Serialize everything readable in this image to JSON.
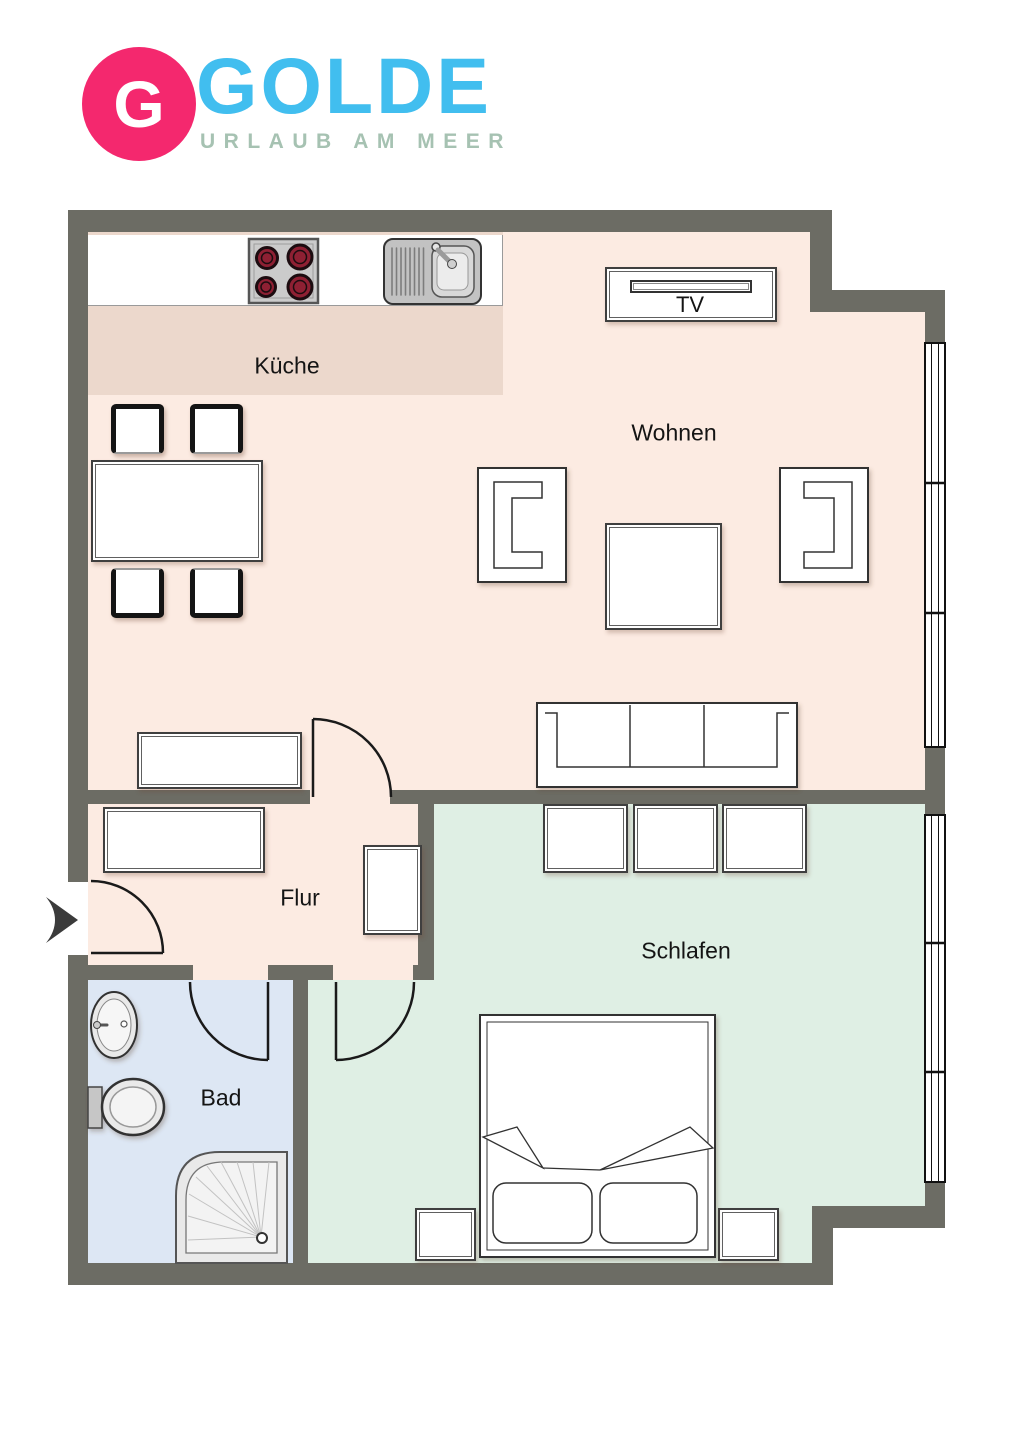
{
  "logo": {
    "badge_letter": "G",
    "brand": "GOLDE",
    "tagline": "URLAUB AM MEER",
    "badge_color": "#F4286E",
    "brand_color": "#41BEEF",
    "tagline_color": "#A6C2B2"
  },
  "floorplan": {
    "wall_color": "#6C6C64",
    "rooms": [
      {
        "id": "kueche",
        "label": "Küche",
        "floor_color": "#ECD8CC"
      },
      {
        "id": "wohnen",
        "label": "Wohnen",
        "floor_color": "#FCEBE2"
      },
      {
        "id": "flur",
        "label": "Flur",
        "floor_color": "#FCEBE2"
      },
      {
        "id": "bad",
        "label": "Bad",
        "floor_color": "#DDE7F4"
      },
      {
        "id": "schlafen",
        "label": "Schlafen",
        "floor_color": "#DFEFE4"
      }
    ],
    "tv_label": "TV",
    "furniture": [
      "stove",
      "kitchen-sink",
      "dining-table",
      "dining-chair x4",
      "tv-sideboard",
      "armchair x2",
      "coffee-table",
      "sofa",
      "sideboard-living",
      "sideboard-hall",
      "cabinet-hall",
      "wardrobe x3",
      "double-bed",
      "nightstand x2",
      "washbasin",
      "toilet",
      "shower"
    ],
    "features": [
      "entrance-arrow",
      "entrance-door",
      "living-room-door",
      "bathroom-door",
      "bedroom-door",
      "window-living",
      "window-bedroom"
    ]
  }
}
